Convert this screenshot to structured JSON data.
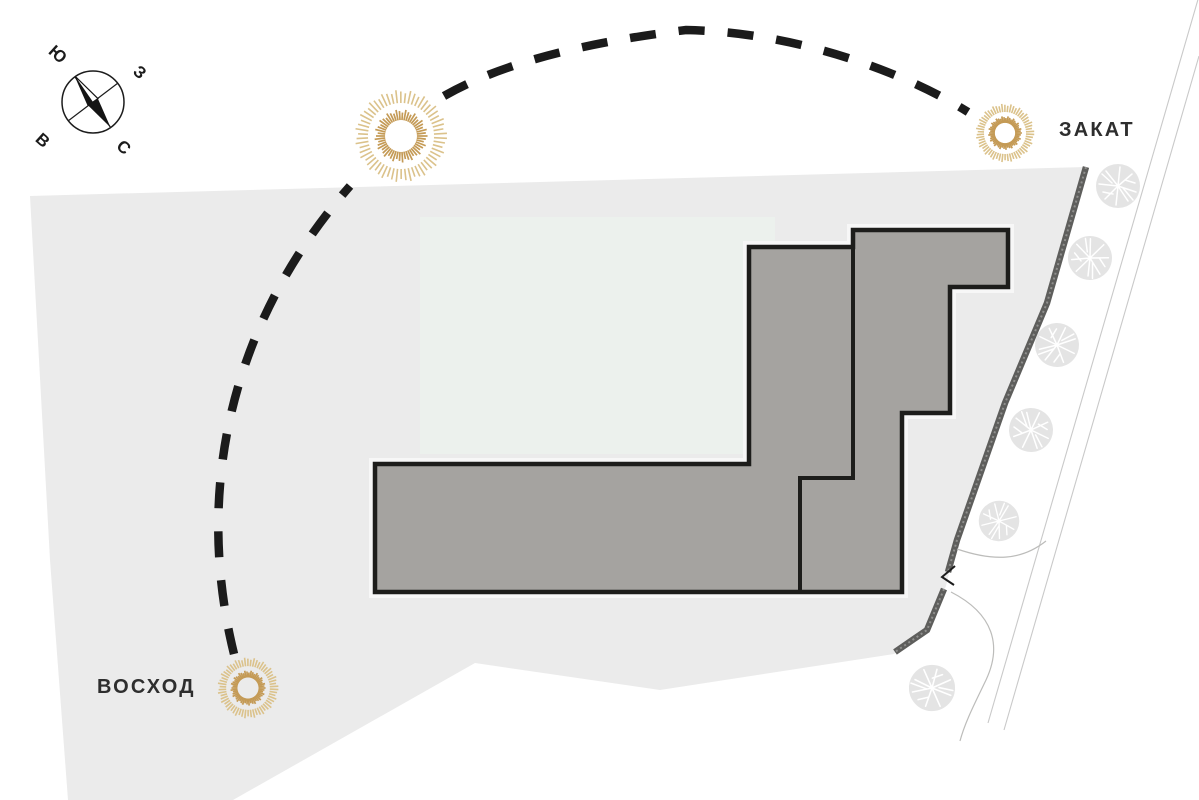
{
  "scene": {
    "description": "Site plan diagram of sun path over a residential plot",
    "sun_path": {
      "sunrise_label": "ВОСХОД",
      "sunset_label": "ЗАКАТ",
      "style": "dashed-arc"
    },
    "compass": {
      "north": "С",
      "south": "Ю",
      "east": "В",
      "west": "З"
    },
    "icons": {
      "sun": "sun-burst-icon",
      "tree": "tree-icon",
      "compass": "compass-rose-icon"
    },
    "colors": {
      "background": "#ffffff",
      "site": "#ebebeb",
      "courtyard": "#ecf1ed",
      "building": "#a5a3a0",
      "outline": "#1d1d1b",
      "dash": "#1b1b1b",
      "sun-inner": "#c49a55",
      "sun-outer": "#dbc28b",
      "strip": "#5e5e5c",
      "strip-grain": "#90908e",
      "road": "#c9c9c9",
      "path": "#bcbcba",
      "tree": "#e4e4e4",
      "tree-vein": "#ffffff",
      "text": "#2e2e2e"
    }
  }
}
